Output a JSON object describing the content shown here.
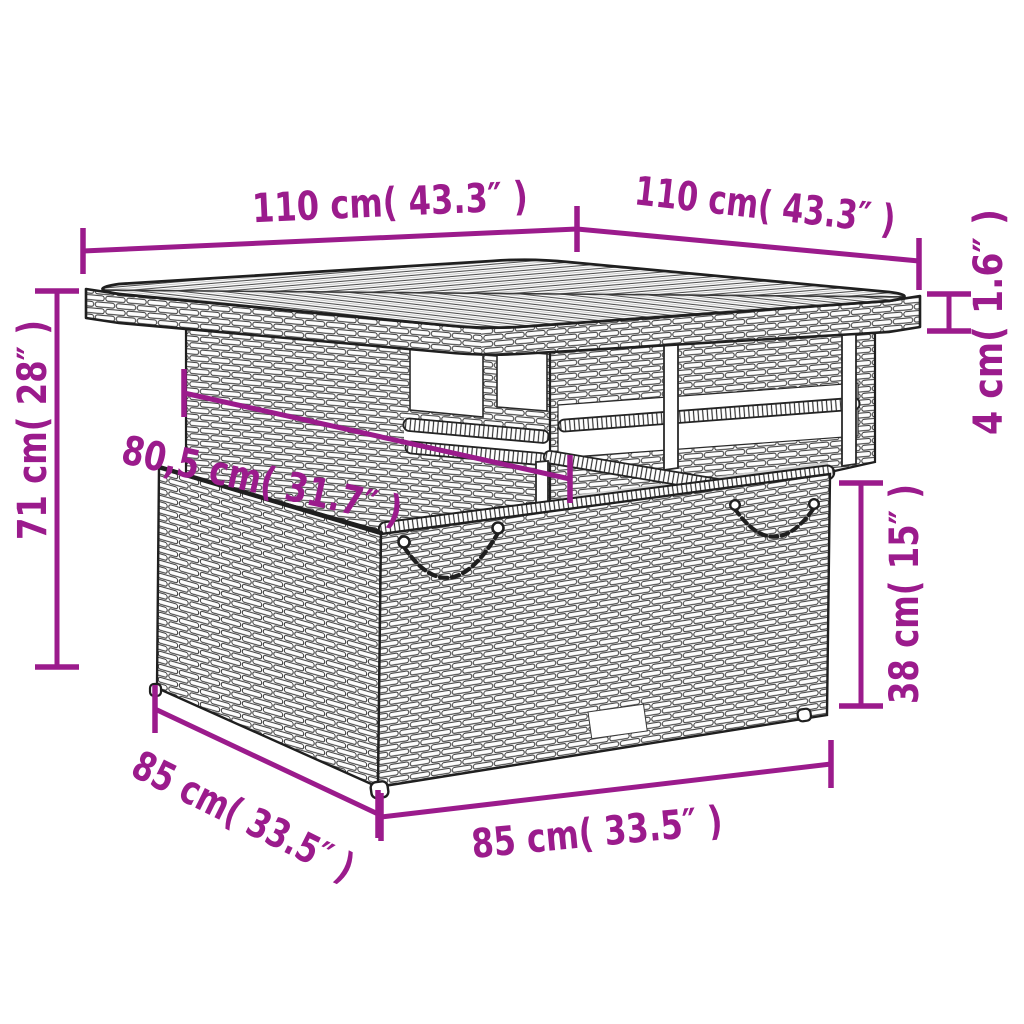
{
  "colors": {
    "accent": "#9B1B8C",
    "ink": "#1f1f1f",
    "background": "#ffffff"
  },
  "dimensions": {
    "top_width_left": "110 cm( 43.3″ )",
    "top_width_right": "110 cm( 43.3″ )",
    "top_thickness": "4 cm( 1.6″ )",
    "overall_height": "71 cm( 28″ )",
    "inner_width": "80,5 cm( 31.7″ )",
    "base_height": "38 cm( 15″ )",
    "base_depth": "85 cm( 33.5″ )",
    "base_width": "85 cm( 33.5″ )"
  }
}
